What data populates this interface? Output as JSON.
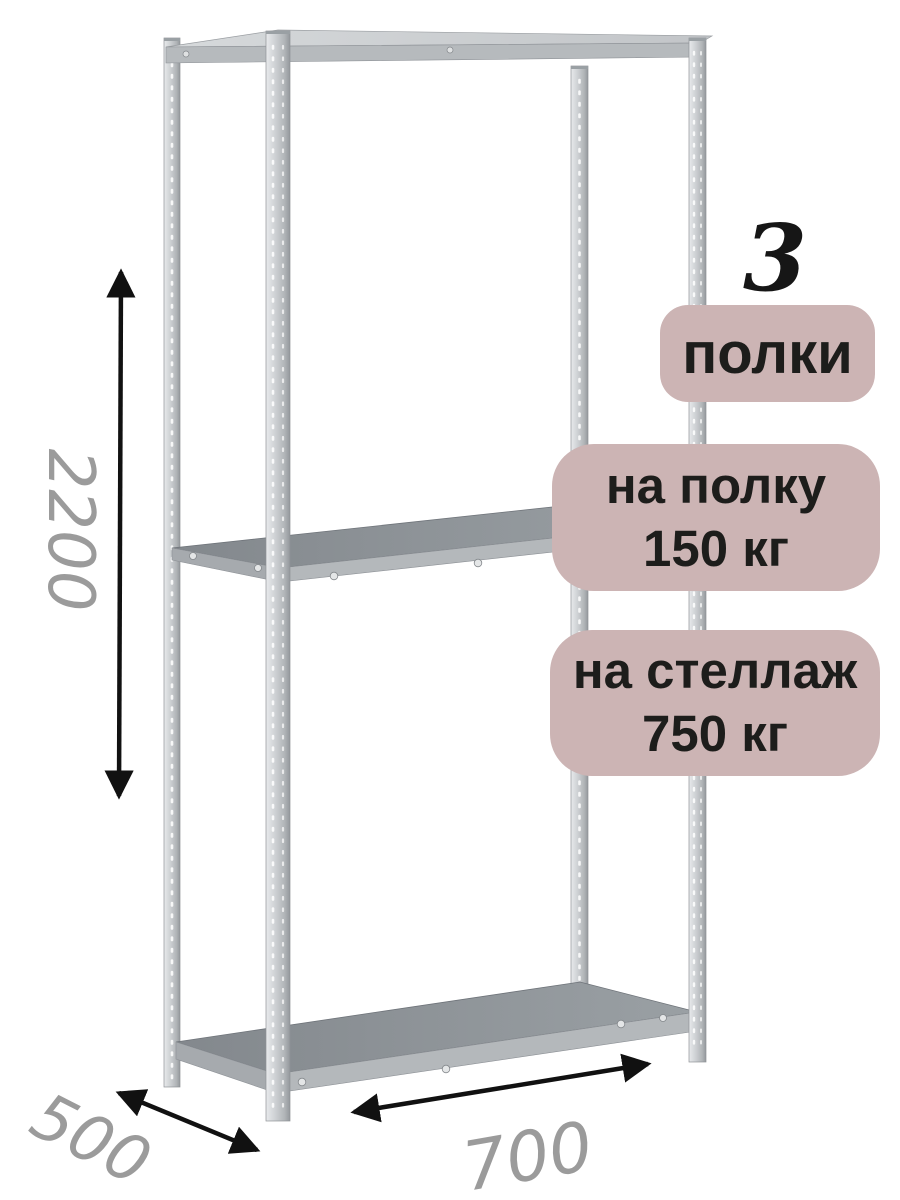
{
  "image": {
    "description": "3D render of a gray metal boltless shelving rack (стеллаж) with three shelves, perforated posts, dimension arrows and load-capacity badges",
    "background": "#ffffff"
  },
  "dimensions": {
    "height": "2200",
    "depth": "500",
    "width": "700"
  },
  "badges": {
    "shelf_count": {
      "number": "3",
      "label": "полки"
    },
    "per_shelf": {
      "line1": "на полку",
      "line2": "150 кг"
    },
    "per_rack": {
      "line1": "на стеллаж",
      "line2": "750 кг"
    }
  },
  "colors": {
    "badge_background": "#ccb4b4",
    "badge_text": "#1d1d1b",
    "dimension_text": "#9b9b9b",
    "arrow": "#111111",
    "metal_light": "#e6e8ea",
    "metal_base": "#c9cccf",
    "metal_shadow": "#9a9ea2",
    "shelf_top_dark": "#8d9297",
    "shelf_front": "#b4b8bb"
  }
}
